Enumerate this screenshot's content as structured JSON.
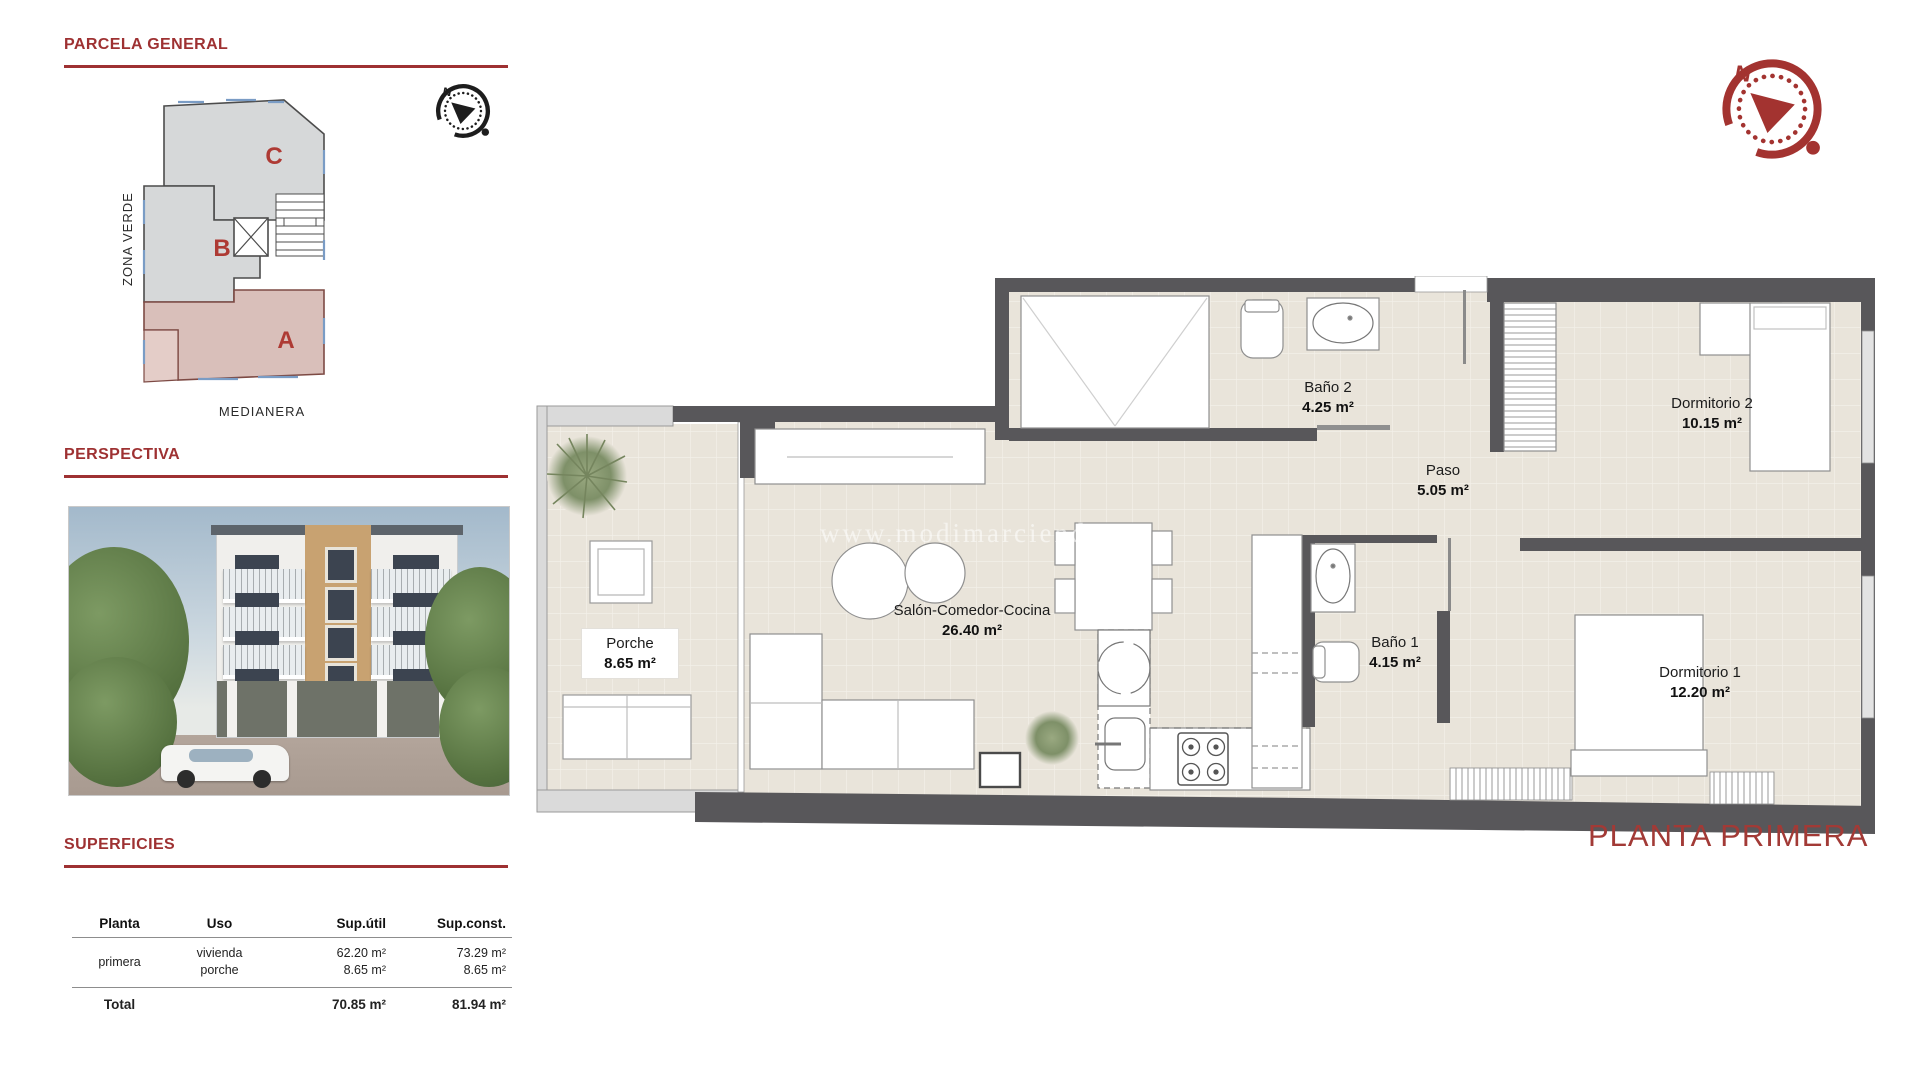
{
  "accent_color": "#9e3132",
  "wall_color": "#58575a",
  "floor_color": "#e9e4da",
  "block_a_color": "#d9bfba",
  "block_bc_color": "#d6d8d9",
  "parcela": {
    "title": "PARCELA GENERAL",
    "zone_label": "ZONA VERDE",
    "medianera_label": "MEDIANERA",
    "blocks": [
      {
        "id": "C"
      },
      {
        "id": "B"
      },
      {
        "id": "A"
      }
    ]
  },
  "perspectiva": {
    "title": "PERSPECTIVA"
  },
  "superficies": {
    "title": "SUPERFICIES",
    "table": {
      "headers": [
        "Planta",
        "Uso",
        "Sup.útil",
        "Sup.const."
      ],
      "rows": [
        {
          "planta": "primera",
          "uso": [
            "vivienda",
            "porche"
          ],
          "sup_util": [
            "62.20 m²",
            "8.65 m²"
          ],
          "sup_const": [
            "73.29 m²",
            "8.65 m²"
          ]
        }
      ],
      "total": {
        "label": "Total",
        "sup_util": "70.85 m²",
        "sup_const": "81.94 m²"
      }
    }
  },
  "compass": {
    "north_label": "N"
  },
  "floorplan": {
    "title": "PLANTA PRIMERA",
    "watermark": "www.modimarciendom",
    "rooms": [
      {
        "name": "Baño 2",
        "area": "4.25 m²"
      },
      {
        "name": "Dormitorio 2",
        "area": "10.15 m²"
      },
      {
        "name": "Paso",
        "area": "5.05 m²"
      },
      {
        "name": "Salón-Comedor-Cocina",
        "area": "26.40 m²"
      },
      {
        "name": "Baño 1",
        "area": "4.15 m²"
      },
      {
        "name": "Dormitorio 1",
        "area": "12.20 m²"
      },
      {
        "name": "Porche",
        "area": "8.65 m²"
      }
    ]
  }
}
